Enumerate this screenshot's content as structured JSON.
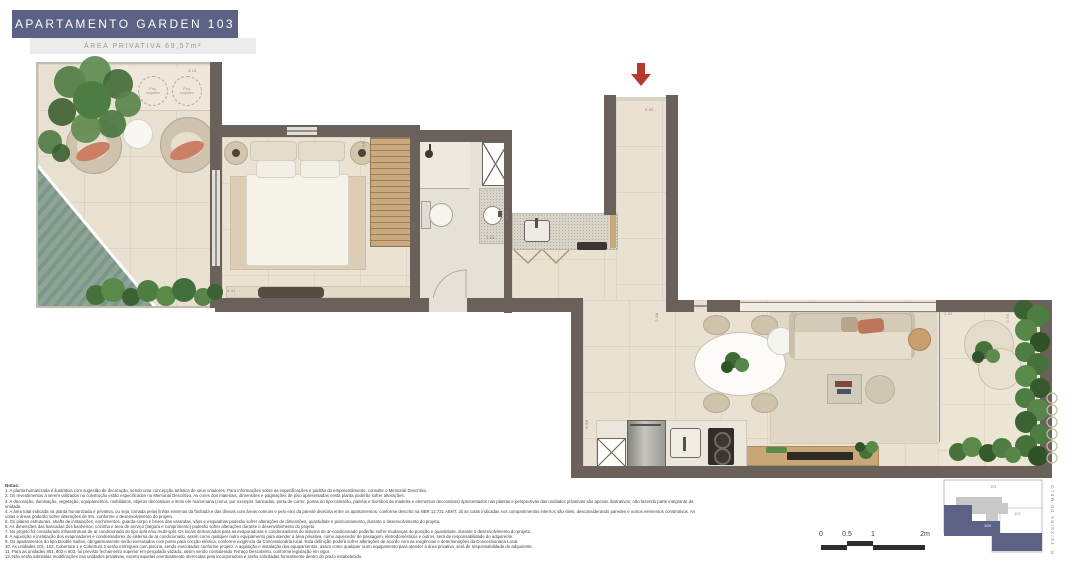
{
  "header": {
    "title": "APARTAMENTO GARDEN 103",
    "subtitle": "ÁREA PRIVATIVA 69,57m²"
  },
  "plan": {
    "proj": {
      "line1": "Proj.",
      "line2": "coqueiro"
    },
    "dimensions": [
      "3.13",
      "0.92",
      "2.99",
      "3.41",
      "1.91",
      "1.63",
      "0.67",
      "2.48",
      "6.68",
      "1.31",
      "2.79"
    ]
  },
  "notes": {
    "heading": "Notas:",
    "lines": [
      "1. A planta humanizada é ilustrativa com sugestão de decoração, sendo uma concepção artística de seus criadores. Para informações sobre as especificações e padrão do empreendimento, consulte o Memorial Descritivo.",
      "2. Os revestimentos a serem utilizados na construção estão especificados no Memorial Descritivo. As cores dos materiais, dimensões e paginações de piso apresentadas nesta planta poderão sofrer alterações.",
      "3. A decoração, iluminação, vegetação, equipamentos, mobiliários, objetos decorativos e itens em marcenaria (como, por exemplo: bancadas, porta de correr, portas do tipo camarão, painéis e biombos de madeira e elementos decorativos) apresentados nas plantas e perspectivas das unidades privativas são apenas ilustrativos, não fazendo parte integrante da unidade.",
      "4. A área total indicada na planta humanizada é privativa, ou seja, tomada pelas linhas externas da fachada e das divisas com áreas comuns e pelo eixo da parede divisória entre os apartamentos, conforme descrito na NBR 12.721 ABNT. Já as cotas indicadas nos compartimentos internos são úteis, desconsiderando paredes e outros elementos construtivos. As cotas e áreas poderão sofrer alterações de 5%, conforme o desenvolvimento do projeto.",
      "5. Os pilares estruturais, shafts de instalações, enchimentos, guarda-corpo e brises das varandas, vãos e esquadrias poderão sofrer alterações de dimensões, quantidade e posicionamento, durante o desenvolvimento do projeto.",
      "6. As dimensões das bancadas dos banheiros, cozinha e área de serviço (largura e comprimento) poderão sofrer alterações durante o desenvolvimento do projeto.",
      "7. No projeto foi considerado infraestrutura de ar condicionado do tipo split e/ou multi-split. Os locais demarcados para as evaporadoras e condensadoras do sistema de ar-condicionado poderão sofrer mudanças de posição e quantidade, durante o desenvolvimento do projeto.",
      "8. A aquisição e instalação dos evaporadores e condensadores do sistema de ar condicionado, assim como qualquer outro equipamento para atender a área privativa, como aquecedor de passagem, eletrodomésticos e outros, será de responsabilidade do adquirente.",
      "9. Os apartamentos do tipo Double Suítes, obrigatoriamente serão executados com ponto para cocção elétrica, conforme exigência da Concessionária local. Esta definição poderá sofrer alterações de acordo com as exigências e determinações da Concessionária Local.",
      "10. As unidades 101, 103, Cobertura 1 e Cobertura 2 serão entregues com piscina, sendo executadas conforme projeto. A aquisição e instalação dos equipamentos, assim como qualquer outro equipamento para atender a área privativa, será de responsabilidade do adquirente.",
      "11. Para as unidades 801, 802 e 803, foi previsto fechamento superior em pergolado vazado, assim sendo considerado Terraço Descoberto, conforme legislação em vigor.",
      "12. Não serão admitidas modificações nas unidades privativas, exceto aquelas eventualmente oferecidas pela incorporadora e serão solicitadas formalmente dentro do prazo estabelecido."
    ]
  },
  "footer": {
    "scale": {
      "labels": [
        "0",
        "0.5",
        "1",
        "2m"
      ]
    },
    "keyplan": {
      "units": [
        "101",
        "102",
        "103"
      ],
      "street": "R. TEIXEIRA DE MELO"
    }
  },
  "colors": {
    "accent_blue": "#5b6284",
    "wall": "#6a625a",
    "arrow_red": "#b5392d",
    "pool_green": "#8da595"
  }
}
